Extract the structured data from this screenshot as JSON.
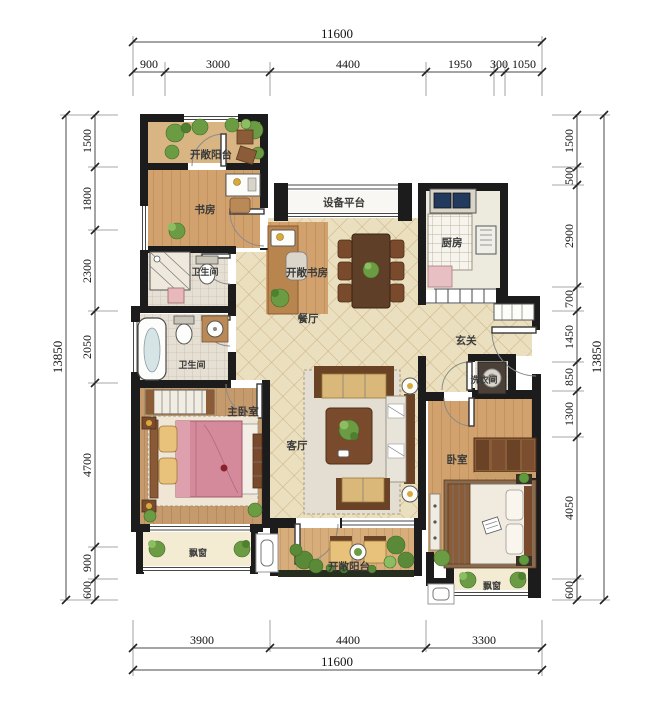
{
  "drawing_title": "apartment-floor-plan",
  "dims": {
    "top": {
      "total": "11600",
      "segments": [
        "900",
        "3000",
        "4400",
        "1950",
        "300",
        "1050"
      ]
    },
    "bottom": {
      "total": "11600",
      "segments": [
        "3900",
        "4400",
        "3300"
      ]
    },
    "left": {
      "total": "13850",
      "segments": [
        "1500",
        "1800",
        "2300",
        "2050",
        "4700",
        "900",
        "600"
      ]
    },
    "right": {
      "total": "13850",
      "segments": [
        "1500",
        "500",
        "2900",
        "700",
        "1450",
        "850",
        "1300",
        "4050",
        "600"
      ]
    }
  },
  "rooms": {
    "balcony_top": "开敞阳台",
    "study": "书房",
    "equipment": "设备平台",
    "kitchen": "厨房",
    "open_study": "开敞书房",
    "bath_upper": "卫生间",
    "dining": "餐厅",
    "bath_lower": "卫生间",
    "entry": "玄关",
    "laundry": "洗衣间",
    "master": "主卧室",
    "living": "客厅",
    "bedroom": "卧室",
    "bay_left": "飘窗",
    "balcony_bottom": "开敞阳台",
    "bay_right": "飘窗"
  },
  "colors": {
    "wall": "#1c1c1c",
    "tile_floor": "#eadfbe",
    "tile_line": "#cdb488",
    "wood_floor": "#d1a26d",
    "master_wood": "#c59b6e",
    "bay_cream": "#f4ecd2",
    "bed_pink": "#d58a9b",
    "sofa_gold": "#d9b87a",
    "plant_green": "#6b9c44",
    "furniture_brown": "#6a4226"
  }
}
